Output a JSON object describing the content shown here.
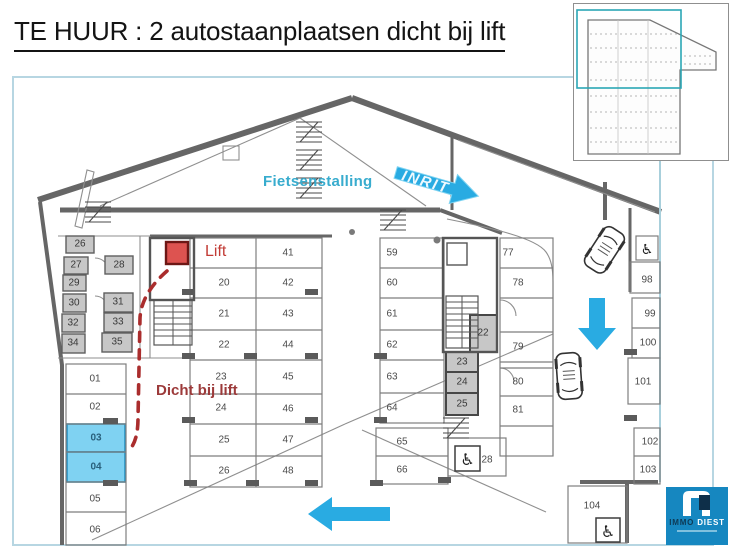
{
  "title": "TE HUUR : 2 autostaanplaatsen dicht bij lift",
  "labels": {
    "fietsenstalling": "Fietsenstalling",
    "inrit": "INRIT",
    "lift": "Lift",
    "dicht_bij_lift": "Dicht bij lift"
  },
  "logo": {
    "name_left": "IMMO",
    "name_right": "DIEST"
  },
  "highlighted_spaces": [
    "03",
    "04"
  ],
  "colors": {
    "accent_blue": "#29abe2",
    "highlight_fill": "#7fd2f2",
    "highlight_border": "#2794c4",
    "lift_red": "#dd5350",
    "route_red": "#aa2d2d",
    "teal_text": "#38acce",
    "dark_red_text": "#9c3a3a",
    "logo_blue": "#1687c0",
    "frame_blue": "#b7d6e2"
  },
  "plan": {
    "spaces": [
      {
        "n": "01",
        "x": 95,
        "y": 379,
        "k": "p"
      },
      {
        "n": "02",
        "x": 95,
        "y": 407,
        "k": "p"
      },
      {
        "n": "03",
        "x": 96,
        "y": 438,
        "k": "h"
      },
      {
        "n": "04",
        "x": 96,
        "y": 467,
        "k": "h"
      },
      {
        "n": "05",
        "x": 95,
        "y": 499,
        "k": "p"
      },
      {
        "n": "06",
        "x": 95,
        "y": 530,
        "k": "p"
      },
      {
        "n": "20",
        "x": 224,
        "y": 283,
        "k": "p"
      },
      {
        "n": "21",
        "x": 224,
        "y": 314,
        "k": "p"
      },
      {
        "n": "22",
        "x": 224,
        "y": 345,
        "k": "p"
      },
      {
        "n": "23",
        "x": 221,
        "y": 377,
        "k": "p"
      },
      {
        "n": "24",
        "x": 221,
        "y": 408,
        "k": "p"
      },
      {
        "n": "25",
        "x": 224,
        "y": 440,
        "k": "p"
      },
      {
        "n": "26",
        "x": 224,
        "y": 471,
        "k": "p"
      },
      {
        "n": "41",
        "x": 288,
        "y": 253,
        "k": "p"
      },
      {
        "n": "42",
        "x": 288,
        "y": 283,
        "k": "p"
      },
      {
        "n": "43",
        "x": 288,
        "y": 314,
        "k": "p"
      },
      {
        "n": "44",
        "x": 288,
        "y": 345,
        "k": "p"
      },
      {
        "n": "45",
        "x": 288,
        "y": 377,
        "k": "p"
      },
      {
        "n": "46",
        "x": 288,
        "y": 409,
        "k": "p"
      },
      {
        "n": "47",
        "x": 288,
        "y": 440,
        "k": "p"
      },
      {
        "n": "48",
        "x": 288,
        "y": 471,
        "k": "p"
      },
      {
        "n": "59",
        "x": 392,
        "y": 253,
        "k": "p"
      },
      {
        "n": "60",
        "x": 392,
        "y": 283,
        "k": "p"
      },
      {
        "n": "61",
        "x": 392,
        "y": 314,
        "k": "p"
      },
      {
        "n": "62",
        "x": 392,
        "y": 345,
        "k": "p"
      },
      {
        "n": "63",
        "x": 392,
        "y": 377,
        "k": "p"
      },
      {
        "n": "64",
        "x": 392,
        "y": 408,
        "k": "p"
      },
      {
        "n": "65",
        "x": 402,
        "y": 442,
        "k": "p"
      },
      {
        "n": "66",
        "x": 402,
        "y": 470,
        "k": "p"
      },
      {
        "n": "77",
        "x": 508,
        "y": 253,
        "k": "p"
      },
      {
        "n": "78",
        "x": 518,
        "y": 283,
        "k": "p"
      },
      {
        "n": "79",
        "x": 518,
        "y": 347,
        "k": "p"
      },
      {
        "n": "80",
        "x": 518,
        "y": 382,
        "k": "p"
      },
      {
        "n": "81",
        "x": 518,
        "y": 410,
        "k": "p"
      },
      {
        "n": "28",
        "x": 487,
        "y": 460,
        "k": "p"
      },
      {
        "n": "98",
        "x": 647,
        "y": 280,
        "k": "p"
      },
      {
        "n": "99",
        "x": 650,
        "y": 314,
        "k": "p"
      },
      {
        "n": "100",
        "x": 648,
        "y": 343,
        "k": "p"
      },
      {
        "n": "101",
        "x": 643,
        "y": 382,
        "k": "p"
      },
      {
        "n": "102",
        "x": 650,
        "y": 442,
        "k": "p"
      },
      {
        "n": "103",
        "x": 648,
        "y": 470,
        "k": "p"
      },
      {
        "n": "104",
        "x": 592,
        "y": 506,
        "k": "p"
      },
      {
        "n": "26",
        "x": 80,
        "y": 244,
        "k": "s"
      },
      {
        "n": "27",
        "x": 76,
        "y": 265,
        "k": "s"
      },
      {
        "n": "28",
        "x": 119,
        "y": 265,
        "k": "s"
      },
      {
        "n": "29",
        "x": 74,
        "y": 283,
        "k": "s"
      },
      {
        "n": "30",
        "x": 74,
        "y": 303,
        "k": "s"
      },
      {
        "n": "31",
        "x": 118,
        "y": 302,
        "k": "s"
      },
      {
        "n": "32",
        "x": 73,
        "y": 323,
        "k": "s"
      },
      {
        "n": "33",
        "x": 118,
        "y": 322,
        "k": "s"
      },
      {
        "n": "34",
        "x": 73,
        "y": 343,
        "k": "s"
      },
      {
        "n": "35",
        "x": 117,
        "y": 342,
        "k": "s"
      },
      {
        "n": "22",
        "x": 483,
        "y": 333,
        "k": "s"
      },
      {
        "n": "23",
        "x": 462,
        "y": 362,
        "k": "s"
      },
      {
        "n": "24",
        "x": 462,
        "y": 382,
        "k": "s"
      },
      {
        "n": "25",
        "x": 462,
        "y": 404,
        "k": "s"
      }
    ]
  }
}
